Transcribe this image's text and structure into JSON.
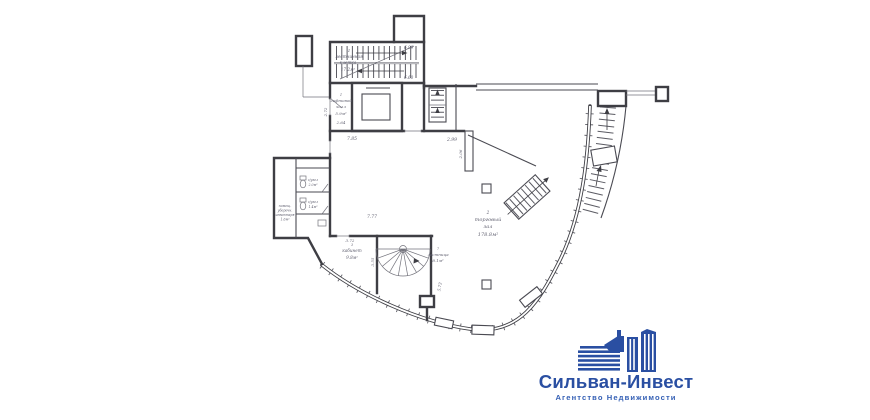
{
  "canvas": {
    "background": "#ffffff",
    "line_color": "#3e3e44",
    "label_color": "#5e5e6e"
  },
  "rooms": {
    "staircase": {
      "num": "1",
      "line1": "лестничная",
      "line2": "клетка",
      "area": "17.2м²"
    },
    "lift_hall": {
      "num": "1",
      "line1": "лифтовой",
      "line2": "холл",
      "area": "5.9м²"
    },
    "trade_hall": {
      "num": "2",
      "line1": "торговый",
      "line2": "зал",
      "area": "178.8м²"
    },
    "cabinet": {
      "num": "3",
      "line1": "кабинет",
      "area": "9.8м²"
    },
    "stair_room": {
      "num": "7",
      "line1": "лестница",
      "area": "8.1м²"
    },
    "cleaning": {
      "line1": "помещ.",
      "line2": "уборочн.",
      "line3": "инвентаря",
      "area": "1.6м²"
    },
    "wc_upper": {
      "line1": "с/узел",
      "area": "2.0м²"
    },
    "wc_lower": {
      "line1": "с/узел",
      "area": "1.4м²"
    }
  },
  "dimensions": {
    "stair_right_top": "6.99",
    "stair_right_bottom": "6.60",
    "lift_hall_width": "2.64",
    "lift_hall_left": "2.72",
    "corridor_length": "7.85",
    "hall_width": "7.77",
    "hall_top_right": "2.99",
    "hall_pier": "2.06",
    "cabinet_width": "3.72",
    "spiral_left": "3.55",
    "hall_bottom": "5.73"
  },
  "logo": {
    "title": "Сильван-Инвест",
    "subtitle": "Агентство Недвижимости",
    "brand_color": "#2a4fa2"
  }
}
